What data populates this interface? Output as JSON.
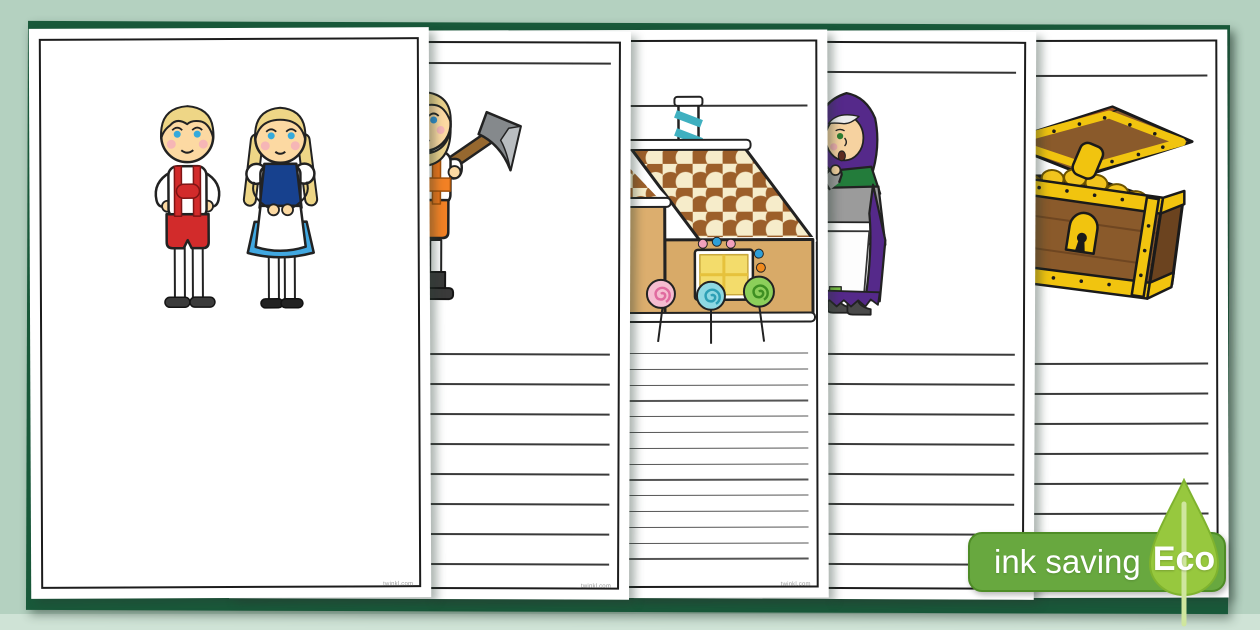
{
  "palette": {
    "background": "#b4d1c0",
    "background_bottom_band": "#cfe3d6",
    "backing_card": "#19593a",
    "page_border": "#1c1c1c",
    "badge_green": "#68a83f",
    "badge_border": "#4e8c26",
    "leaf_green": "#97c83e"
  },
  "badge": {
    "label": "ink saving",
    "eco": "Eco"
  },
  "pages": [
    {
      "id": "hansel-and-gretel",
      "illustration": "hansel-and-gretel-characters",
      "footer": "twinkl.com",
      "title_line": false,
      "ruled_lines": {
        "count": 0
      }
    },
    {
      "id": "woodcutter",
      "illustration": "woodcutter-with-axe",
      "footer": "twinkl.com",
      "title_line": true,
      "ruled_lines": {
        "count": 8,
        "spacing": 30,
        "first_y": 322
      }
    },
    {
      "id": "gingerbread-house",
      "illustration": "gingerbread-candy-house",
      "footer": "twinkl.com",
      "title_line": true,
      "ruled_lines": {
        "count": 14,
        "spacing": 15.8,
        "first_y": 323
      }
    },
    {
      "id": "witch",
      "illustration": "old-witch",
      "footer": "twinkl.com",
      "title_line": true,
      "ruled_lines": {
        "count": 8,
        "spacing": 30,
        "first_y": 322
      }
    },
    {
      "id": "treasure-chest",
      "illustration": "treasure-chest-with-gold",
      "footer": "twinkl.com",
      "title_line": true,
      "ruled_lines": {
        "count": 8,
        "spacing": 30,
        "first_y": 333
      }
    }
  ]
}
